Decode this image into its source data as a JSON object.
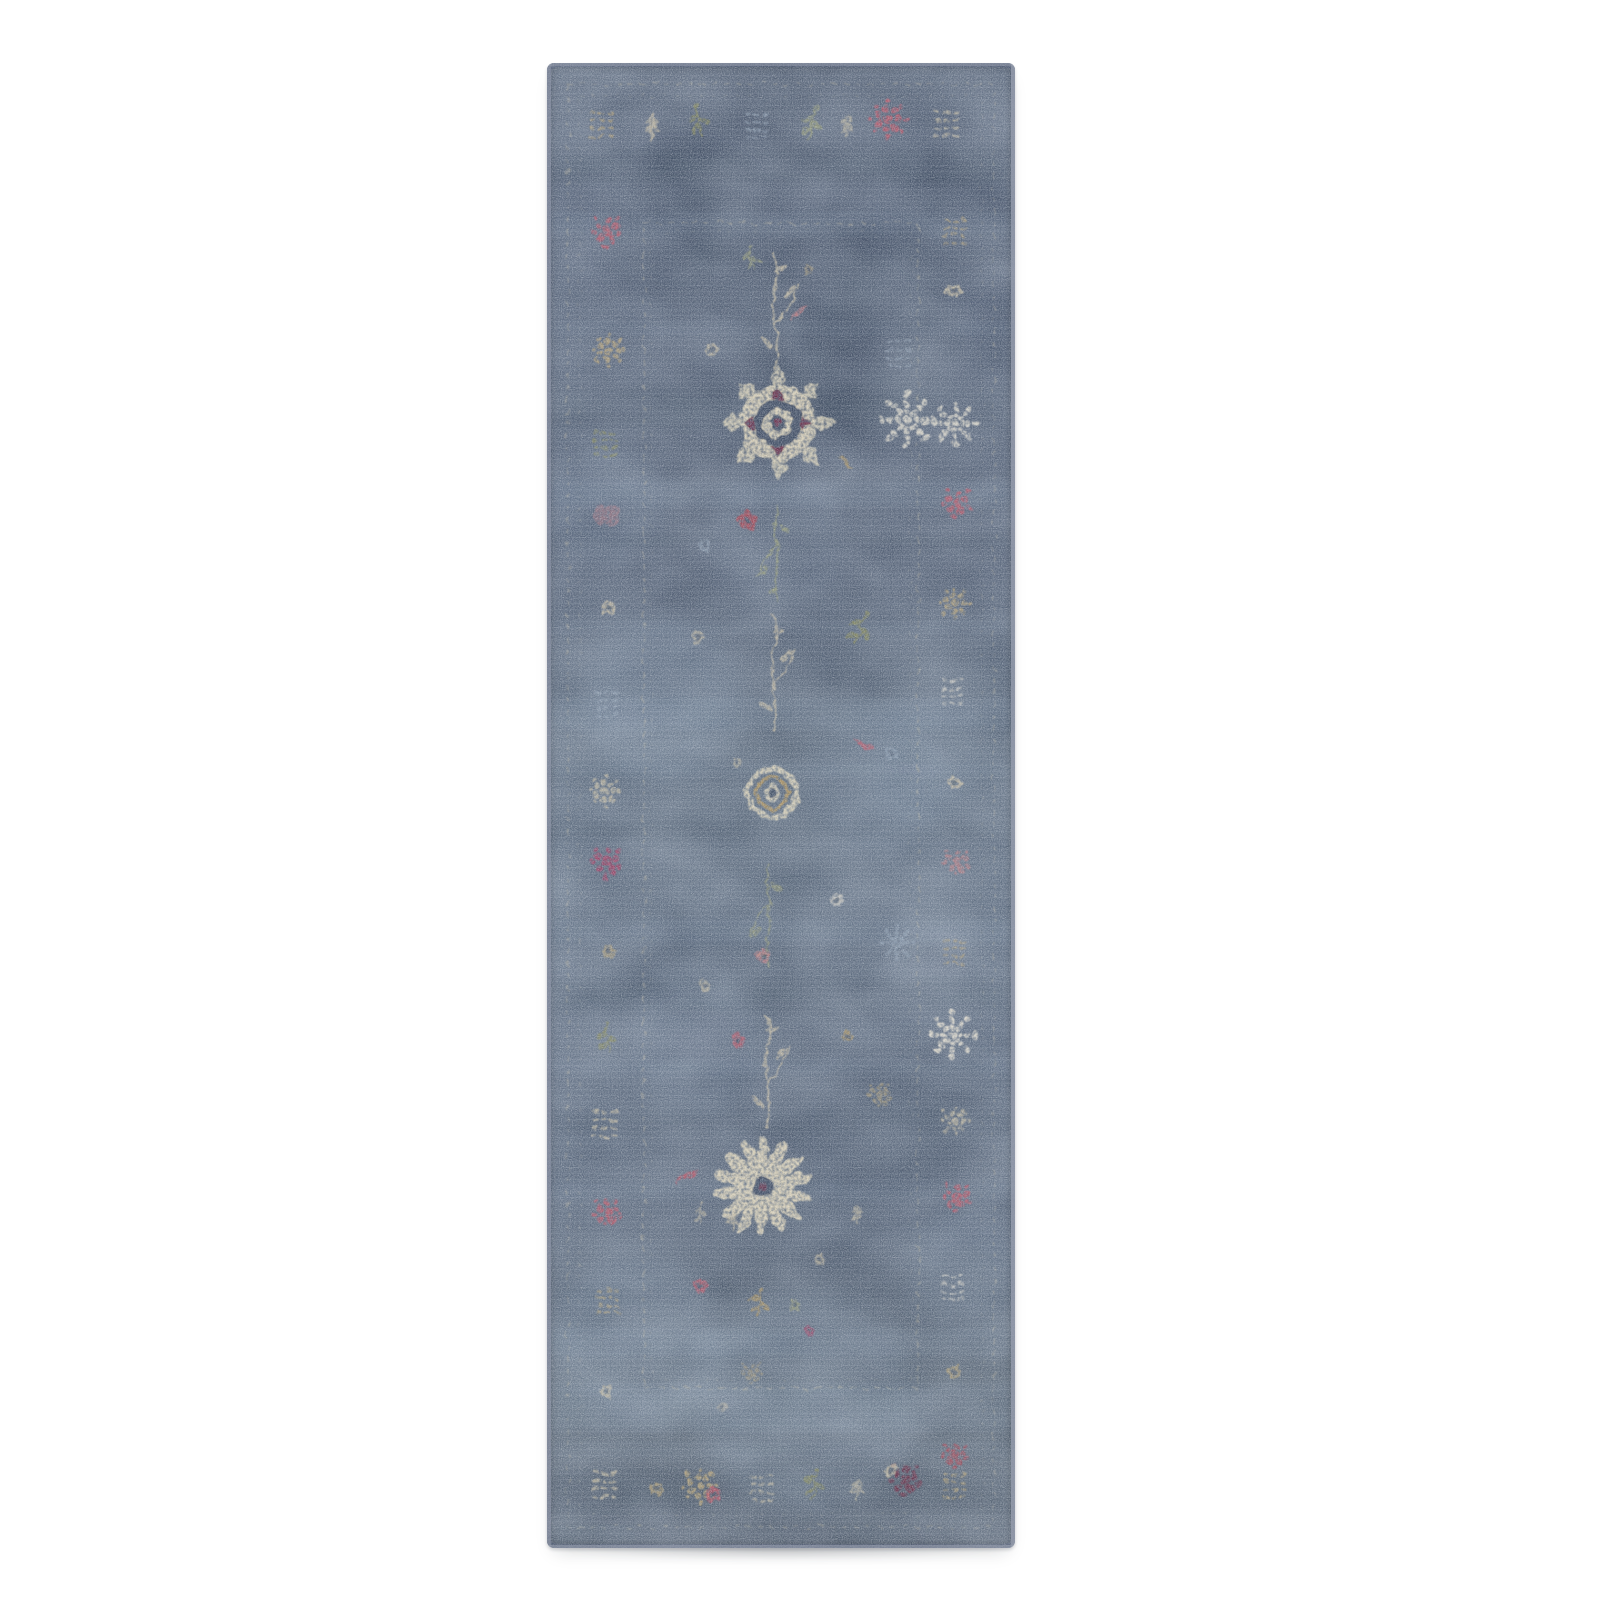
{
  "scene": {
    "type": "product-photo",
    "subject": "distressed vintage-style floral runner rug, slate blue with cream, tan, olive and rose motifs",
    "background_color": "#ffffff"
  },
  "rug": {
    "layout": {
      "x": 547,
      "y": 63,
      "width": 468,
      "height": 1485,
      "corner_radius": 7
    },
    "shadow": {
      "x": 560,
      "y": 1538,
      "width": 440,
      "height": 22
    },
    "palette": {
      "base_blue": "#4d5a70",
      "band_light": "#8ea4bc",
      "band_dark": "#2c3a4e",
      "patch_light": "#93a7bf",
      "patch_dark": "#2b394d",
      "patch_pale": "#b9c4d2",
      "guard": "#cfc5ab",
      "cream": "#d3c6a9",
      "cream_bright": "#e2d7bc",
      "white": "#e8e2d2",
      "tan": "#bfa878",
      "gold": "#b99a5f",
      "olive": "#8f8f55",
      "sage": "#a3a578",
      "pale_blue": "#9fb0c2",
      "pink": "#c87f82",
      "rose": "#c25667",
      "red": "#b04250",
      "magenta": "#a63d62",
      "maroon": "#6e2a44",
      "field_dark": "#3c4a5f",
      "selvedge": "#a7afba"
    },
    "gradient_stops": [
      [
        "#515e73",
        0
      ],
      [
        "#49566d",
        0.1
      ],
      [
        "#4e5b71",
        0.22
      ],
      [
        "#4a576d",
        0.34
      ],
      [
        "#556477",
        0.46
      ],
      [
        "#5b6a7e",
        0.56
      ],
      [
        "#546277",
        0.66
      ],
      [
        "#4e5c71",
        0.78
      ],
      [
        "#53606f",
        0.9
      ],
      [
        "#566273",
        1
      ]
    ],
    "frames": [
      {
        "x": 21,
        "y": 21,
        "w": 426,
        "h": 1443,
        "sw": 1.6,
        "dash": "5 7",
        "o": 0.38
      },
      {
        "x": 33,
        "y": 33,
        "w": 402,
        "h": 1419,
        "sw": 1.2,
        "dash": "3 9",
        "o": 0.22
      },
      {
        "x": 97,
        "y": 160,
        "w": 274,
        "h": 1165,
        "sw": 1.8,
        "dash": "6 6",
        "o": 0.4
      },
      {
        "x": 104,
        "y": 168,
        "w": 260,
        "h": 1149,
        "sw": 1.2,
        "dash": "3 10",
        "o": 0.18
      }
    ],
    "bands": [
      {
        "y": 150,
        "h": 22,
        "c": "light",
        "o": 0.1
      },
      {
        "y": 258,
        "h": 14,
        "c": "light",
        "o": 0.08
      },
      {
        "y": 418,
        "h": 26,
        "c": "light",
        "o": 0.12
      },
      {
        "y": 558,
        "h": 12,
        "c": "light",
        "o": 0.08
      },
      {
        "y": 636,
        "h": 30,
        "c": "light",
        "o": 0.13
      },
      {
        "y": 700,
        "h": 14,
        "c": "light",
        "o": 0.08
      },
      {
        "y": 856,
        "h": 24,
        "c": "light",
        "o": 0.11
      },
      {
        "y": 996,
        "h": 16,
        "c": "light",
        "o": 0.08
      },
      {
        "y": 1118,
        "h": 20,
        "c": "light",
        "o": 0.1
      },
      {
        "y": 1266,
        "h": 28,
        "c": "light",
        "o": 0.12
      },
      {
        "y": 1322,
        "h": 46,
        "c": "light",
        "o": 0.16
      },
      {
        "y": 1378,
        "h": 18,
        "c": "light",
        "o": 0.08
      },
      {
        "y": 86,
        "h": 34,
        "c": "dark",
        "o": 0.16
      },
      {
        "y": 326,
        "h": 40,
        "c": "dark",
        "o": 0.15
      },
      {
        "y": 470,
        "h": 16,
        "c": "dark",
        "o": 0.1
      },
      {
        "y": 758,
        "h": 18,
        "c": "dark",
        "o": 0.1
      },
      {
        "y": 916,
        "h": 32,
        "c": "dark",
        "o": 0.13
      },
      {
        "y": 1048,
        "h": 22,
        "c": "dark",
        "o": 0.1
      },
      {
        "y": 1224,
        "h": 14,
        "c": "dark",
        "o": 0.08
      },
      {
        "y": 1408,
        "h": 40,
        "c": "dark",
        "o": 0.14
      }
    ],
    "patches": [
      {
        "x": 113,
        "y": 637,
        "r": 80,
        "c": "light",
        "o": 0.2
      },
      {
        "x": 330,
        "y": 720,
        "r": 70,
        "c": "light",
        "o": 0.14
      },
      {
        "x": 90,
        "y": 1278,
        "r": 85,
        "c": "light",
        "o": 0.22
      },
      {
        "x": 258,
        "y": 1338,
        "r": 110,
        "c": "light",
        "o": 0.2
      },
      {
        "x": 380,
        "y": 700,
        "r": 60,
        "c": "light",
        "o": 0.12
      },
      {
        "x": 228,
        "y": 478,
        "r": 70,
        "c": "light",
        "o": 0.12
      },
      {
        "x": 420,
        "y": 1210,
        "r": 60,
        "c": "light",
        "o": 0.14
      },
      {
        "x": 60,
        "y": 440,
        "r": 60,
        "c": "light",
        "o": 0.12
      },
      {
        "x": 150,
        "y": 980,
        "r": 70,
        "c": "light",
        "o": 0.12
      },
      {
        "x": 395,
        "y": 905,
        "r": 55,
        "c": "pale",
        "o": 0.1
      },
      {
        "x": 300,
        "y": 268,
        "r": 110,
        "c": "dark",
        "o": 0.22
      },
      {
        "x": 370,
        "y": 1062,
        "r": 85,
        "c": "dark",
        "o": 0.16
      },
      {
        "x": 140,
        "y": 170,
        "r": 80,
        "c": "dark",
        "o": 0.16
      },
      {
        "x": 420,
        "y": 150,
        "r": 70,
        "c": "dark",
        "o": 0.18
      },
      {
        "x": 60,
        "y": 1470,
        "r": 80,
        "c": "dark",
        "o": 0.16
      },
      {
        "x": 300,
        "y": 1462,
        "r": 95,
        "c": "dark",
        "o": 0.14
      },
      {
        "x": 80,
        "y": 870,
        "r": 60,
        "c": "dark",
        "o": 0.12
      },
      {
        "x": 350,
        "y": 1260,
        "r": 70,
        "c": "dark",
        "o": 0.12
      }
    ],
    "motif_format": [
      "type",
      "x",
      "y",
      "scale",
      "color_key",
      "rotation_deg",
      "opacity"
    ],
    "border_motifs": [
      [
        "lattice",
        55,
        60,
        0.9,
        "tan",
        0,
        0.7
      ],
      [
        "tree",
        105,
        64,
        0.9,
        "cream",
        0,
        0.75
      ],
      [
        "sprig",
        152,
        58,
        0.9,
        "olive",
        -10,
        0.7
      ],
      [
        "lattice",
        210,
        62,
        0.85,
        "pale_blue",
        0,
        0.6
      ],
      [
        "sprig",
        265,
        60,
        0.95,
        "sage",
        12,
        0.7
      ],
      [
        "tree",
        300,
        64,
        0.8,
        "cream",
        0,
        0.6
      ],
      [
        "pompom",
        341,
        56,
        1.15,
        "rose",
        0,
        0.85
      ],
      [
        "lattice",
        400,
        60,
        0.9,
        "cream",
        0,
        0.7
      ],
      [
        "lattice",
        58,
        1421,
        0.9,
        "cream",
        0,
        0.7
      ],
      [
        "blossom",
        110,
        1426,
        0.8,
        "tan",
        15,
        0.7
      ],
      [
        "pompom",
        153,
        1423,
        1.1,
        "tan",
        0,
        0.85
      ],
      [
        "flower5",
        166,
        1432,
        0.7,
        "rose",
        0,
        0.8
      ],
      [
        "lattice",
        215,
        1424,
        0.9,
        "cream",
        0,
        0.65
      ],
      [
        "sprig",
        268,
        1421,
        0.9,
        "olive",
        8,
        0.7
      ],
      [
        "tree",
        310,
        1426,
        0.75,
        "cream",
        0,
        0.6
      ],
      [
        "cluster",
        358,
        1417,
        1.2,
        "maroon",
        0,
        0.85
      ],
      [
        "blossom",
        344,
        1408,
        0.7,
        "cream",
        0,
        0.8
      ],
      [
        "lattice",
        408,
        1422,
        0.85,
        "tan",
        0,
        0.7
      ],
      [
        "cluster",
        60,
        168,
        1.15,
        "rose",
        0,
        0.8
      ],
      [
        "pompom",
        62,
        287,
        1.0,
        "tan",
        0,
        0.8
      ],
      [
        "lattice",
        58,
        380,
        0.85,
        "olive",
        0,
        0.6
      ],
      [
        "patch",
        60,
        452,
        1.0,
        "pink",
        0,
        0.45
      ],
      [
        "blossom",
        62,
        545,
        0.85,
        "cream",
        10,
        0.75
      ],
      [
        "lattice",
        60,
        640,
        0.85,
        "pale_blue",
        0,
        0.5
      ],
      [
        "pompom",
        58,
        728,
        0.95,
        "cream",
        0,
        0.7
      ],
      [
        "cluster",
        60,
        799,
        1.2,
        "magenta",
        0,
        0.85
      ],
      [
        "blossom",
        62,
        888,
        0.8,
        "tan",
        0,
        0.65
      ],
      [
        "sprig",
        60,
        975,
        0.9,
        "olive",
        -8,
        0.65
      ],
      [
        "lattice",
        58,
        1060,
        0.9,
        "cream",
        0,
        0.7
      ],
      [
        "cluster",
        60,
        1150,
        1.05,
        "rose",
        0,
        0.8
      ],
      [
        "lattice",
        62,
        1238,
        0.85,
        "tan",
        0,
        0.6
      ],
      [
        "blossom",
        60,
        1328,
        0.8,
        "cream",
        0,
        0.7
      ],
      [
        "lattice",
        408,
        168,
        0.85,
        "tan",
        0,
        0.65
      ],
      [
        "blossom",
        406,
        228,
        0.9,
        "cream",
        0,
        0.8
      ],
      [
        "snowflake",
        408,
        360,
        1.25,
        "white",
        0,
        0.85
      ],
      [
        "cluster",
        410,
        440,
        1.1,
        "rose",
        0,
        0.8
      ],
      [
        "pompom",
        408,
        540,
        0.95,
        "tan",
        0,
        0.75
      ],
      [
        "lattice",
        406,
        628,
        0.85,
        "white",
        0,
        0.6
      ],
      [
        "blossom",
        408,
        720,
        0.85,
        "cream",
        0,
        0.75
      ],
      [
        "cluster",
        410,
        799,
        1.0,
        "pink",
        0,
        0.7
      ],
      [
        "lattice",
        408,
        888,
        0.85,
        "tan",
        0,
        0.6
      ],
      [
        "snowflake",
        405,
        972,
        1.35,
        "white",
        0,
        0.9
      ],
      [
        "pompom",
        408,
        1058,
        0.9,
        "cream",
        0,
        0.7
      ],
      [
        "cluster",
        410,
        1134,
        1.1,
        "rose",
        0,
        0.8
      ],
      [
        "lattice",
        406,
        1224,
        0.85,
        "white",
        0,
        0.6
      ],
      [
        "blossom",
        408,
        1308,
        0.85,
        "tan",
        0,
        0.7
      ],
      [
        "cluster",
        408,
        1392,
        1.0,
        "red",
        0,
        0.75
      ]
    ],
    "field_motifs": [
      [
        "rosette",
        231,
        360,
        1.0,
        "cream_bright",
        0,
        0.95
      ],
      [
        "stem",
        228,
        250,
        1.0,
        "cream",
        0,
        0.8
      ],
      [
        "leaf",
        253,
        248,
        0.9,
        "pink",
        -35,
        0.8
      ],
      [
        "sprig",
        205,
        196,
        0.8,
        "sage",
        -15,
        0.7
      ],
      [
        "blossom",
        262,
        206,
        0.6,
        "tan",
        0,
        0.6
      ],
      [
        "blossom",
        165,
        287,
        0.8,
        "cream",
        0,
        0.7
      ],
      [
        "leaf",
        300,
        400,
        0.8,
        "gold",
        40,
        0.7
      ],
      [
        "flower5",
        200,
        457,
        0.9,
        "red",
        0,
        0.85
      ],
      [
        "stem",
        230,
        490,
        0.85,
        "sage",
        180,
        0.7
      ],
      [
        "blossom",
        158,
        482,
        0.7,
        "pale_blue",
        0,
        0.6
      ],
      [
        "snowflake",
        360,
        357,
        1.6,
        "white",
        0,
        0.85
      ],
      [
        "lattice",
        352,
        290,
        0.9,
        "pale_blue",
        0,
        0.5
      ],
      [
        "ringflower",
        225,
        730,
        0.8,
        "cream_bright",
        0,
        0.9
      ],
      [
        "stem",
        226,
        612,
        1.0,
        "cream",
        0,
        0.75
      ],
      [
        "sprig",
        313,
        567,
        1.0,
        "olive",
        25,
        0.75
      ],
      [
        "leaf",
        318,
        682,
        0.9,
        "rose",
        30,
        0.8
      ],
      [
        "blossom",
        150,
        575,
        0.7,
        "cream",
        0,
        0.65
      ],
      [
        "blossom",
        190,
        700,
        0.6,
        "cream",
        0,
        0.6
      ],
      [
        "blossom",
        345,
        690,
        0.7,
        "pale_blue",
        0,
        0.55
      ],
      [
        "blossom",
        291,
        837,
        0.8,
        "white",
        0,
        0.7
      ],
      [
        "stem",
        222,
        850,
        0.9,
        "sage",
        180,
        0.65
      ],
      [
        "flower5",
        216,
        892,
        0.6,
        "pink",
        0,
        0.75
      ],
      [
        "snowflake",
        350,
        880,
        1.0,
        "pale_blue",
        0,
        0.6
      ],
      [
        "blossom",
        158,
        922,
        0.7,
        "cream",
        0,
        0.65
      ],
      [
        "stem",
        220,
        1010,
        1.0,
        "cream",
        0,
        0.75
      ],
      [
        "flower5",
        191,
        977,
        0.65,
        "rose",
        0,
        0.8
      ],
      [
        "blossom",
        301,
        972,
        0.7,
        "gold",
        0,
        0.7
      ],
      [
        "cluster",
        333,
        1032,
        0.9,
        "tan",
        0,
        0.6
      ],
      [
        "chrys",
        216,
        1124,
        1.05,
        "cream_bright",
        0,
        0.95
      ],
      [
        "leaf",
        140,
        1114,
        1.0,
        "rose",
        -25,
        0.8
      ],
      [
        "tree",
        186,
        1158,
        0.7,
        "cream",
        0,
        0.7
      ],
      [
        "tree",
        310,
        1152,
        0.7,
        "cream",
        0,
        0.65
      ],
      [
        "sprig",
        153,
        1150,
        0.6,
        "cream",
        0,
        0.6
      ],
      [
        "blossom",
        273,
        1197,
        0.7,
        "cream",
        0,
        0.7
      ],
      [
        "flower5",
        153,
        1222,
        0.6,
        "rose",
        0,
        0.75
      ],
      [
        "sprig",
        213,
        1240,
        0.9,
        "gold",
        10,
        0.7
      ],
      [
        "blossom",
        248,
        1243,
        0.7,
        "sage",
        0,
        0.65
      ],
      [
        "flower5",
        262,
        1268,
        0.5,
        "magenta",
        0,
        0.7
      ],
      [
        "cluster",
        205,
        1310,
        0.8,
        "tan",
        0,
        0.5
      ],
      [
        "blossom",
        175,
        1345,
        0.6,
        "cream",
        0,
        0.5
      ]
    ],
    "selvedge": [
      {
        "x": 0,
        "y": 0,
        "w": 4,
        "h": 1485,
        "o": 0.55
      },
      {
        "x": 464,
        "y": 0,
        "w": 4,
        "h": 1485,
        "o": 0.8
      },
      {
        "x": 0,
        "y": 0,
        "w": 468,
        "h": 3,
        "o": 0.5
      },
      {
        "x": 0,
        "y": 1482,
        "w": 468,
        "h": 3,
        "o": 0.6
      }
    ]
  }
}
